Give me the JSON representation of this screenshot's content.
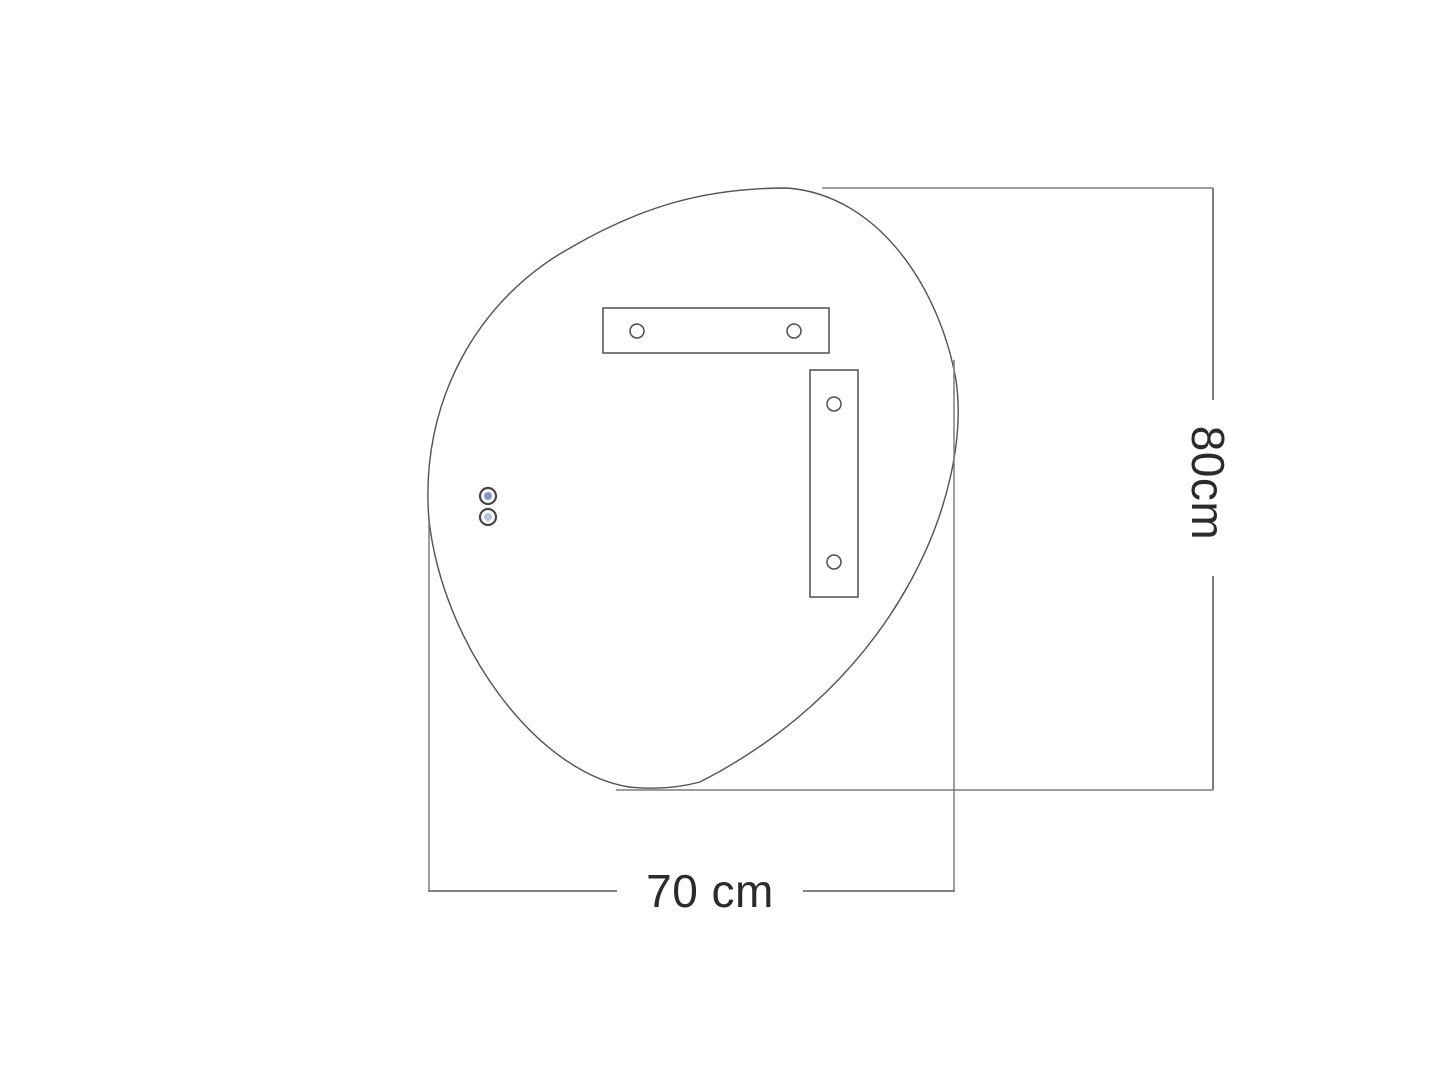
{
  "diagram": {
    "kind": "mirror-dimension-drawing",
    "dimensions": {
      "width": {
        "label": "70 cm",
        "value": 70,
        "unit": "cm"
      },
      "height": {
        "label": "80cm",
        "value": 80,
        "unit": "cm"
      }
    },
    "colors": {
      "background": "#ffffff",
      "outline": "#525252",
      "dimension_line": "#6f6f6f",
      "extension_line": "#7d7d7d",
      "text": "#2b2b2b",
      "sensor_top": "#8b93cc",
      "sensor_bottom": "#b9c3e4"
    }
  }
}
